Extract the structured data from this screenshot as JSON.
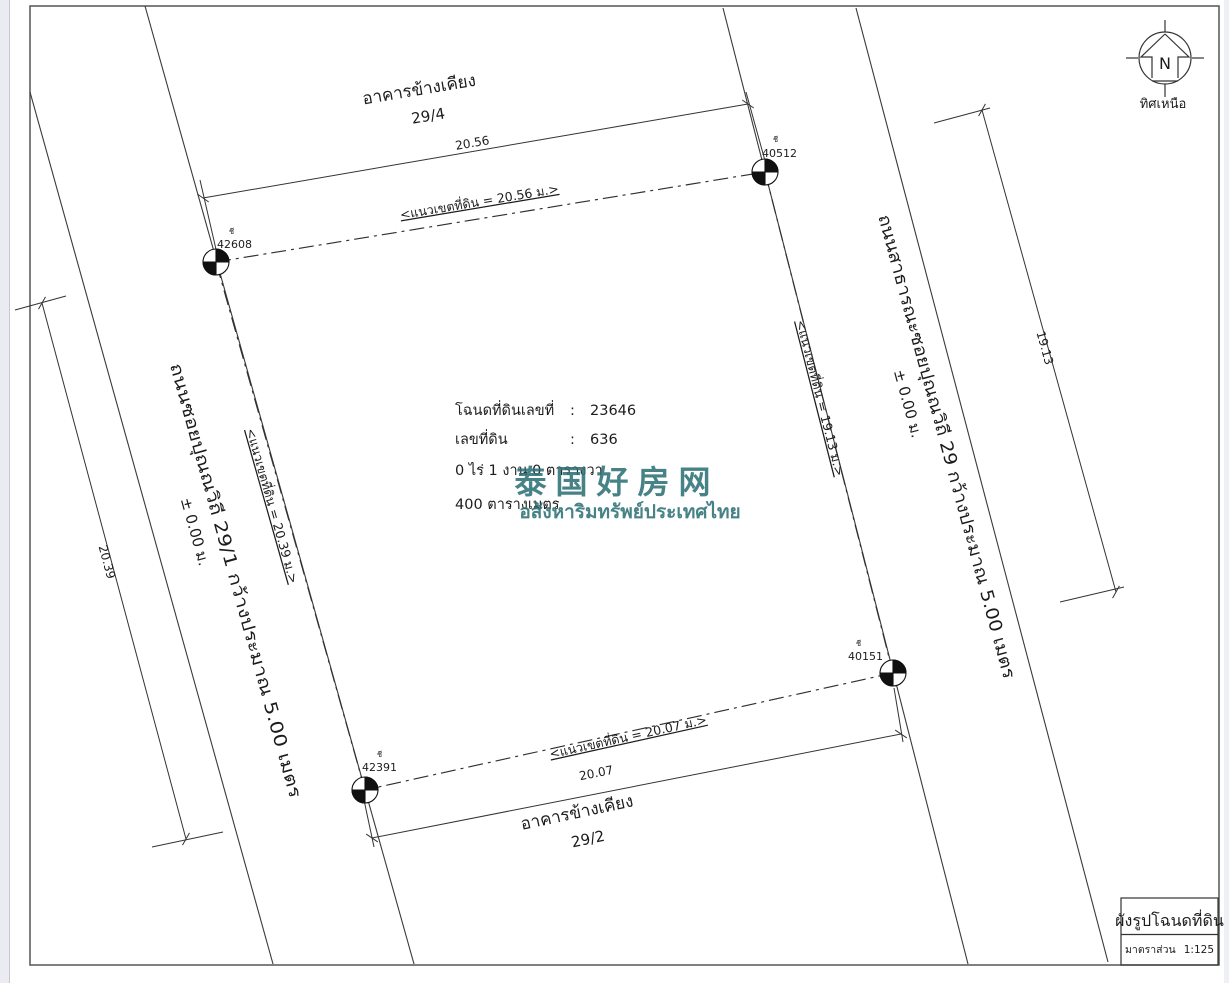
{
  "compass": {
    "letter": "N",
    "label": "ทิศเหนือ"
  },
  "deed": {
    "row1_label": "โฉนดที่ดินเลขที่",
    "row1_sep": ":",
    "row1_value": "23646",
    "row2_label": "เลขที่ดิน",
    "row2_sep": ":",
    "row2_value": "636",
    "area_rai_line": "0   ไร่   1   งาน   0   ตารางวา",
    "area_sqm_line": "400  ตารางเมตร"
  },
  "watermark": {
    "cn": "泰国好房网",
    "th": "อสังหาริมทรัพย์ประเทศไทย",
    "color": "#2e7276"
  },
  "neighbor_top": {
    "name": "อาคารข้างเคียง",
    "house_no": "29/4"
  },
  "neighbor_bottom": {
    "name": "อาคารข้างเคียง",
    "house_no": "29/2"
  },
  "road_left": {
    "name": "ถนนซอยปุณณวิถี 29/1  กว้างประมาณ 5.00 เมตร",
    "level": "±  0.00  ม."
  },
  "road_right": {
    "name": "ถนนสาธารณะซอยปุณณวิถี 29  กว้างประมาณ 5.00 เมตร",
    "level": "±  0.00  ม."
  },
  "boundary_top": {
    "label": "<แนวเขตที่ดิน  =  20.56  ม.>",
    "dim": "20.56"
  },
  "boundary_right": {
    "label": "<แนวเขตที่ดิน = 19.13 ม.>",
    "dim": "19.13"
  },
  "boundary_bottom": {
    "label": "<แนวเขตที่ดิน =  20.07  ม.>",
    "dim": "20.07"
  },
  "boundary_left": {
    "label": "<แนวเขตที่ดิน = 20.39 ม.>",
    "dim": "20.39"
  },
  "markers": {
    "nw": {
      "prefix": "ชี",
      "id": "42608"
    },
    "ne": {
      "prefix": "ชี",
      "id": "40512"
    },
    "se": {
      "prefix": "ชี",
      "id": "40151"
    },
    "sw": {
      "prefix": "ชี",
      "id": "42391"
    }
  },
  "title_block": {
    "title": "ผังรูปโฉนดที่ดิน",
    "scale_label": "มาตราส่วน",
    "scale_value": "1:125"
  }
}
